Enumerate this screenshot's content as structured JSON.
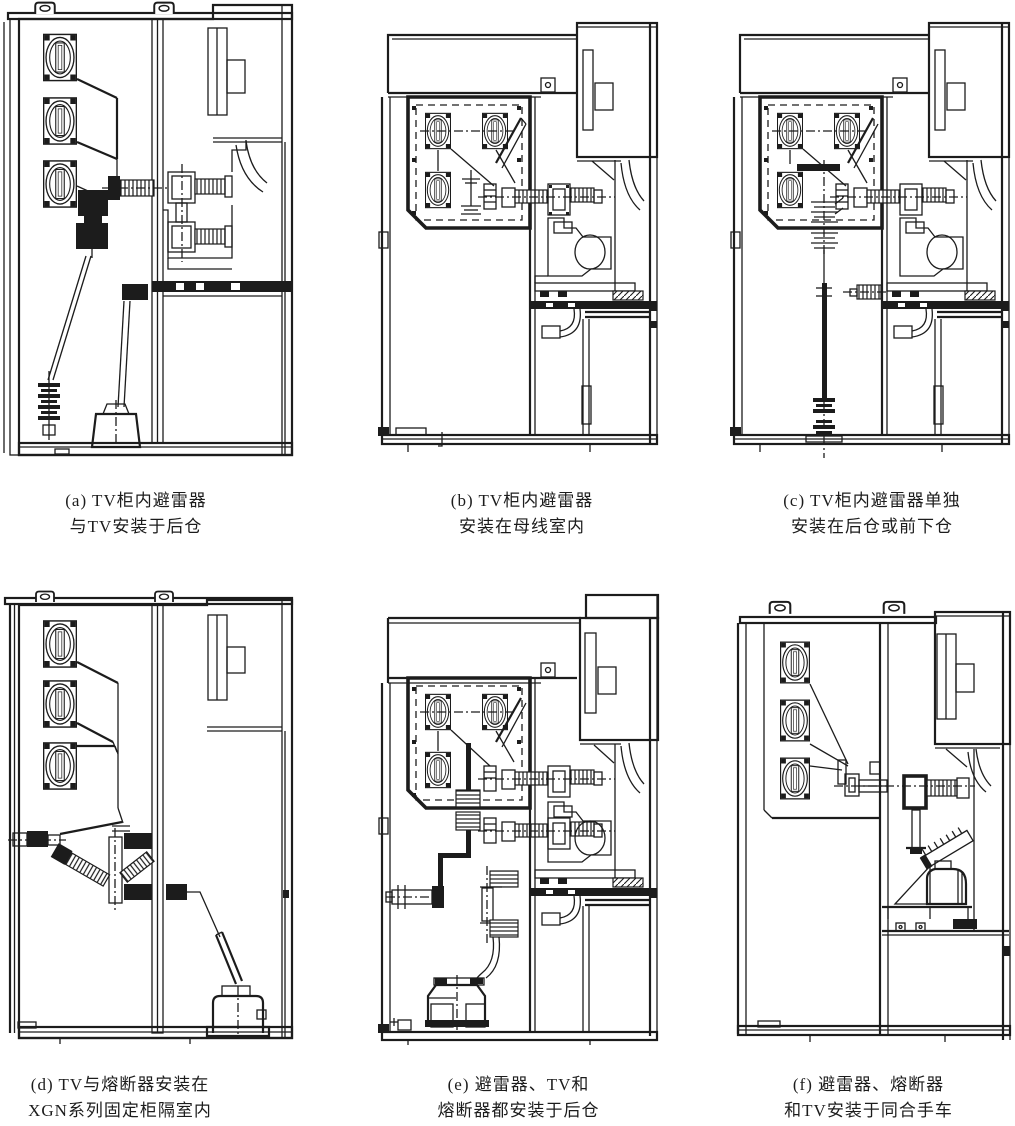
{
  "page": {
    "background": "#ffffff",
    "line_color": "#1c1c1c"
  },
  "figures": [
    {
      "id": "a",
      "caption_line1": "(a) TV柜内避雷器",
      "caption_line2": "与TV安装于后仓"
    },
    {
      "id": "b",
      "caption_line1": "(b) TV柜内避雷器",
      "caption_line2": "安装在母线室内"
    },
    {
      "id": "c",
      "caption_line1": "(c) TV柜内避雷器单独",
      "caption_line2": "安装在后仓或前下仓"
    },
    {
      "id": "d",
      "caption_line1": "(d) TV与熔断器安装在",
      "caption_line2": "XGN系列固定柜隔室内"
    },
    {
      "id": "e",
      "caption_line1": "(e) 避雷器、TV和",
      "caption_line2": "熔断器都安装于后仓"
    },
    {
      "id": "f",
      "caption_line1": "(f) 避雷器、熔断器",
      "caption_line2": "和TV安装于同合手车"
    }
  ]
}
